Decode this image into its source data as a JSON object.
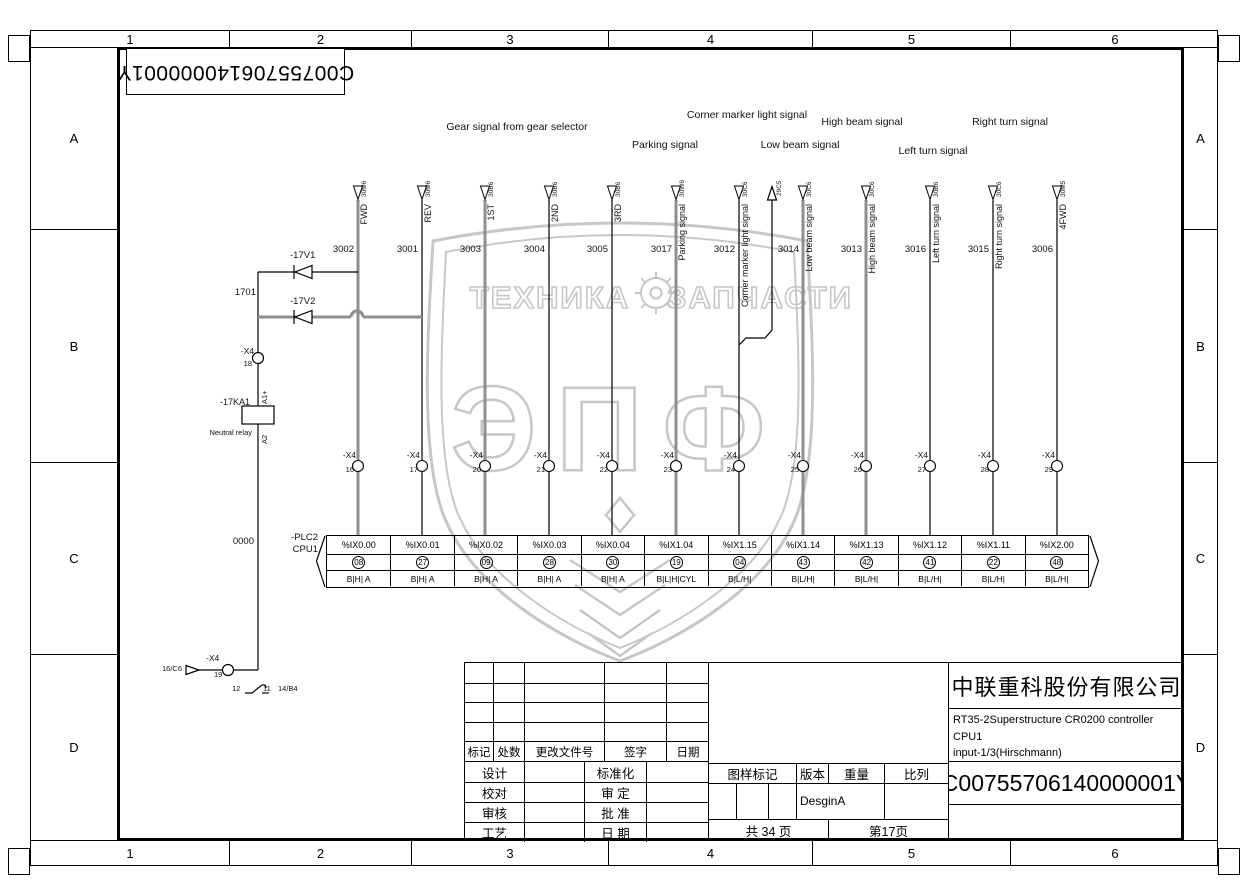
{
  "sheet": {
    "columns": [
      "1",
      "2",
      "3",
      "4",
      "5",
      "6"
    ],
    "rows": [
      "A",
      "B",
      "C",
      "D"
    ],
    "top_left_number": "C00755706140000001Y"
  },
  "group_labels": [
    "Gear signal from gear selector",
    "Parking signal",
    "Corner marker light signal",
    "Low beam signal",
    "High beam signal",
    "Left turn signal",
    "Right turn signal"
  ],
  "signals": [
    {
      "name": "FWD",
      "wire": "3002",
      "ref": "30M6",
      "pin": "16",
      "plc_address": "%IX0.00",
      "plc_pin": "08",
      "plc_type": "B|H| A"
    },
    {
      "name": "REV",
      "wire": "3001",
      "ref": "30M6",
      "pin": "17",
      "plc_address": "%IX0.01",
      "plc_pin": "27",
      "plc_type": "B|H| A"
    },
    {
      "name": "1ST",
      "wire": "3003",
      "ref": "30B6",
      "pin": "20",
      "plc_address": "%IX0.02",
      "plc_pin": "09",
      "plc_type": "B|H| A"
    },
    {
      "name": "2ND",
      "wire": "3004",
      "ref": "30B6",
      "pin": "21",
      "plc_address": "%IX0.03",
      "plc_pin": "28",
      "plc_type": "B|H| A"
    },
    {
      "name": "3RD",
      "wire": "3005",
      "ref": "30B6",
      "pin": "22",
      "plc_address": "%IX0.04",
      "plc_pin": "30",
      "plc_type": "B|H| A"
    },
    {
      "name": "Parking signal",
      "wire": "3017",
      "ref": "30W6",
      "pin": "23",
      "plc_address": "%IX1.04",
      "plc_pin": "19",
      "plc_type": "B|L|H|CYL"
    },
    {
      "name": "Corner marker light signal",
      "wire": "3012",
      "ref": "30C6",
      "pin": "24",
      "branch_ref": "29C5",
      "plc_address": "%IX1.15",
      "plc_pin": "04",
      "plc_type": "B|L/H|"
    },
    {
      "name": "Low beam signal",
      "wire": "3014",
      "ref": "30C6",
      "pin": "25",
      "plc_address": "%IX1.14",
      "plc_pin": "43",
      "plc_type": "B|L/H|"
    },
    {
      "name": "High beam signal",
      "wire": "3013",
      "ref": "30C6",
      "pin": "26",
      "plc_address": "%IX1.13",
      "plc_pin": "42",
      "plc_type": "B|L/H|"
    },
    {
      "name": "Left turn signal",
      "wire": "3016",
      "ref": "30B6",
      "pin": "27",
      "plc_address": "%IX1.12",
      "plc_pin": "41",
      "plc_type": "B|L/H|"
    },
    {
      "name": "Right turn signal",
      "wire": "3015",
      "ref": "30C6",
      "pin": "28",
      "plc_address": "%IX1.11",
      "plc_pin": "22",
      "plc_type": "B|L/H|"
    },
    {
      "name": "4FWD",
      "wire": "3006",
      "ref": "30M5",
      "pin": "29",
      "plc_address": "%IX2.00",
      "plc_pin": "48",
      "plc_type": "B|L/H|"
    }
  ],
  "plc": {
    "device": "-PLC2",
    "cpu": "CPU1",
    "common_wire": "0000",
    "terminal_name": "-X4"
  },
  "left_circuit": {
    "diode1": "-17V1",
    "diode2": "-17V2",
    "wire_1701": "1701",
    "terminal_pin_18": "18",
    "relay": "-17KA1",
    "relay_desc": "Neutral relay",
    "coil_a1": "A1+",
    "coil_a2": "A2",
    "bottom_ref": "16/C6",
    "terminal_pin_19": "19",
    "contact_pin_a": "12",
    "contact_pin_b": "11",
    "contact_ref": "14/B4"
  },
  "titleblock": {
    "rev_headers": [
      "标记",
      "处数",
      "更改文件号",
      "签字",
      "日期"
    ],
    "sig_rows": [
      [
        "设计",
        "标准化"
      ],
      [
        "校对",
        "审 定"
      ],
      [
        "审核",
        "批 准"
      ],
      [
        "工艺",
        "日 期"
      ]
    ],
    "stamp_headers": [
      "图样标记",
      "版本",
      "重量",
      "比列"
    ],
    "version_value": "DesginA",
    "pages_total": "共 34 页",
    "page_current": "第17页",
    "company": "中联重科股份有限公司",
    "title_line1": "RT35-2Superstructure CR0200 controller CPU1",
    "title_line2": "input-1/3(Hirschmann)",
    "drawing_number": "C00755706140000001Y"
  },
  "watermark": {
    "line1": "ТЕХНИКА",
    "line2": "ЗАПЧАСТИ",
    "big": "ЭПФ"
  }
}
